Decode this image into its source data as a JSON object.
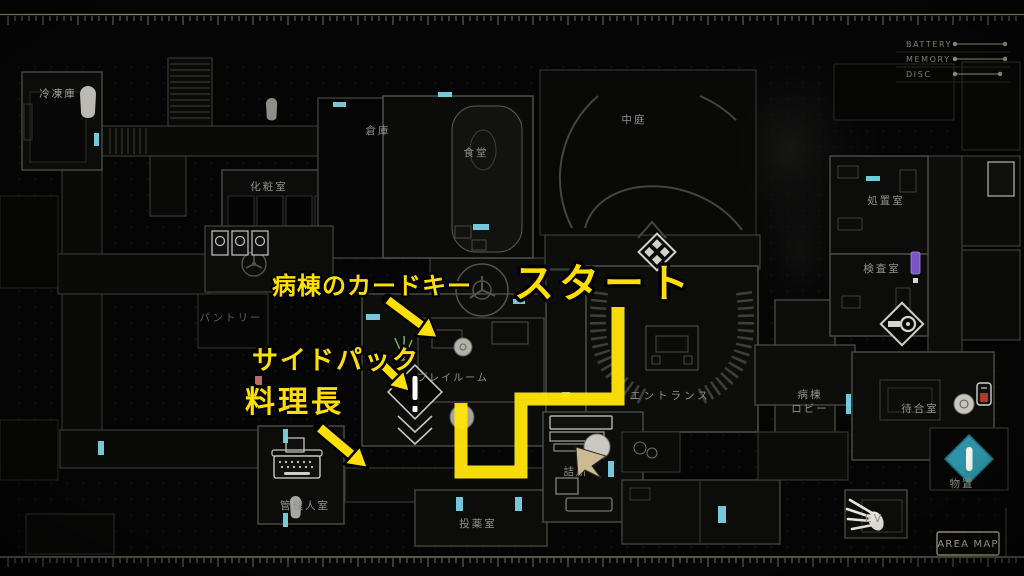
{
  "screen": {
    "type": "game-area-map"
  },
  "hud": {
    "meters": [
      {
        "label": "BATTERY"
      },
      {
        "label": "MEMORY"
      },
      {
        "label": "DISC"
      }
    ],
    "area_map_label": "AREA MAP"
  },
  "rooms": [
    {
      "id": "freezer",
      "label": "冷凍庫"
    },
    {
      "id": "powder_room",
      "label": "化粧室"
    },
    {
      "id": "storehouse",
      "label": "倉庫"
    },
    {
      "id": "dining_hall",
      "label": "食堂"
    },
    {
      "id": "courtyard",
      "label": "中庭"
    },
    {
      "id": "treatment_room",
      "label": "処置室"
    },
    {
      "id": "exam_room",
      "label": "検査室"
    },
    {
      "id": "pantry",
      "label": "パントリー"
    },
    {
      "id": "playroom",
      "label": "プレイルーム"
    },
    {
      "id": "entrance",
      "label": "エントランス"
    },
    {
      "id": "ward_lobby_line1",
      "label": "病棟"
    },
    {
      "id": "ward_lobby_line2",
      "label": "ロビー"
    },
    {
      "id": "waiting_room",
      "label": "待合室"
    },
    {
      "id": "caretaker_room",
      "label": "管理人室"
    },
    {
      "id": "medication_room",
      "label": "投薬室"
    },
    {
      "id": "station",
      "label": "詰所"
    },
    {
      "id": "storage",
      "label": "物置"
    },
    {
      "id": "elevator",
      "label": "EV"
    }
  ],
  "annotations": {
    "card_key": "病棟のカードキー",
    "side_pack": "サイドパック",
    "head_chef": "料理長",
    "start": "スタート"
  },
  "icons": {
    "door_marker": "cyan-bar",
    "typewriter": "save-point",
    "exclamation_diamond": "item-marker",
    "four_dot_diamond": "item-box-marker",
    "key_diamond": "key-item-marker",
    "teal_diamond_bar": "objective-marker",
    "hand": "hand-print",
    "ghost_figure": "body-marker",
    "player_arrow": "player-position"
  },
  "colors": {
    "route_yellow": "#ffe408",
    "annotation_yellow": "#ffdf00",
    "door_cyan": "#7bd2e6",
    "storage_teal": "#2e93a6",
    "player_tan": "#ccba94",
    "hud_beige": "#b3b093",
    "item_purple": "#7b55c8",
    "item_red": "#bf6868"
  }
}
